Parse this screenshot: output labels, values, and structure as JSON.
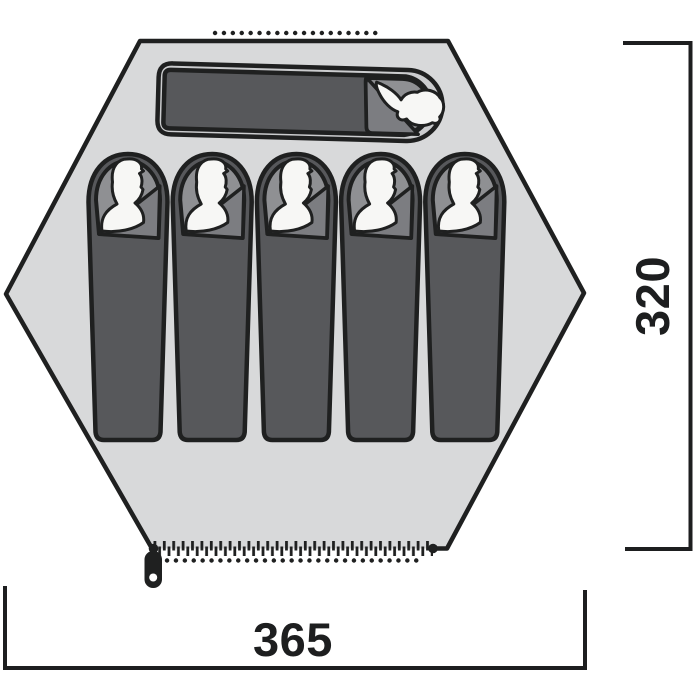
{
  "diagram": {
    "type": "tent-floorplan-top-view",
    "capacity_persons": 6,
    "dimensions": {
      "height": {
        "label": "320",
        "side": "right"
      },
      "width": {
        "label": "365",
        "side": "bottom"
      }
    },
    "sleeping_bags": {
      "vertical_count": 5,
      "horizontal_count": 1
    },
    "features": {
      "door_zipper": "bottom edge with zipper pull",
      "vent_top": "dotted line",
      "vent_bottom": "dotted line"
    },
    "colors": {
      "background": "#ffffff",
      "floor": "#d8d9da",
      "outline": "#1f2020",
      "bag": "#57585b",
      "bag_ring": "#cbccce",
      "hood": "#8f9093",
      "flap": "#7c7d81",
      "silhouette": "#f7f7f5",
      "dimension": "#1d1e1f"
    }
  }
}
